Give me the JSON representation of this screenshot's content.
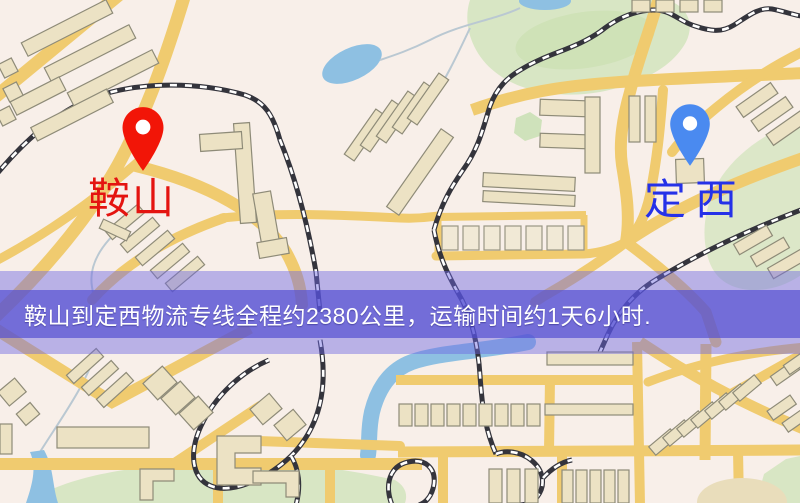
{
  "banner": {
    "text": "鞍山到定西物流专线全程约2380公里，运输时间约1天6小时.",
    "bg_color": "#5650d4",
    "text_color": "#ffffff"
  },
  "map": {
    "origin": {
      "label": "鞍山",
      "text_color": "#e41410",
      "pin_color": "#f21507"
    },
    "destination": {
      "label": "定西",
      "text_color": "#2531e8",
      "pin_color": "#4a8af0"
    }
  },
  "palette": {
    "map_background": "#f8efe9",
    "road": "#f2cb6b",
    "building": "#ece2c3",
    "park": "#d8e6c3",
    "water": "#8cc0e4",
    "railway": "#34343c"
  }
}
